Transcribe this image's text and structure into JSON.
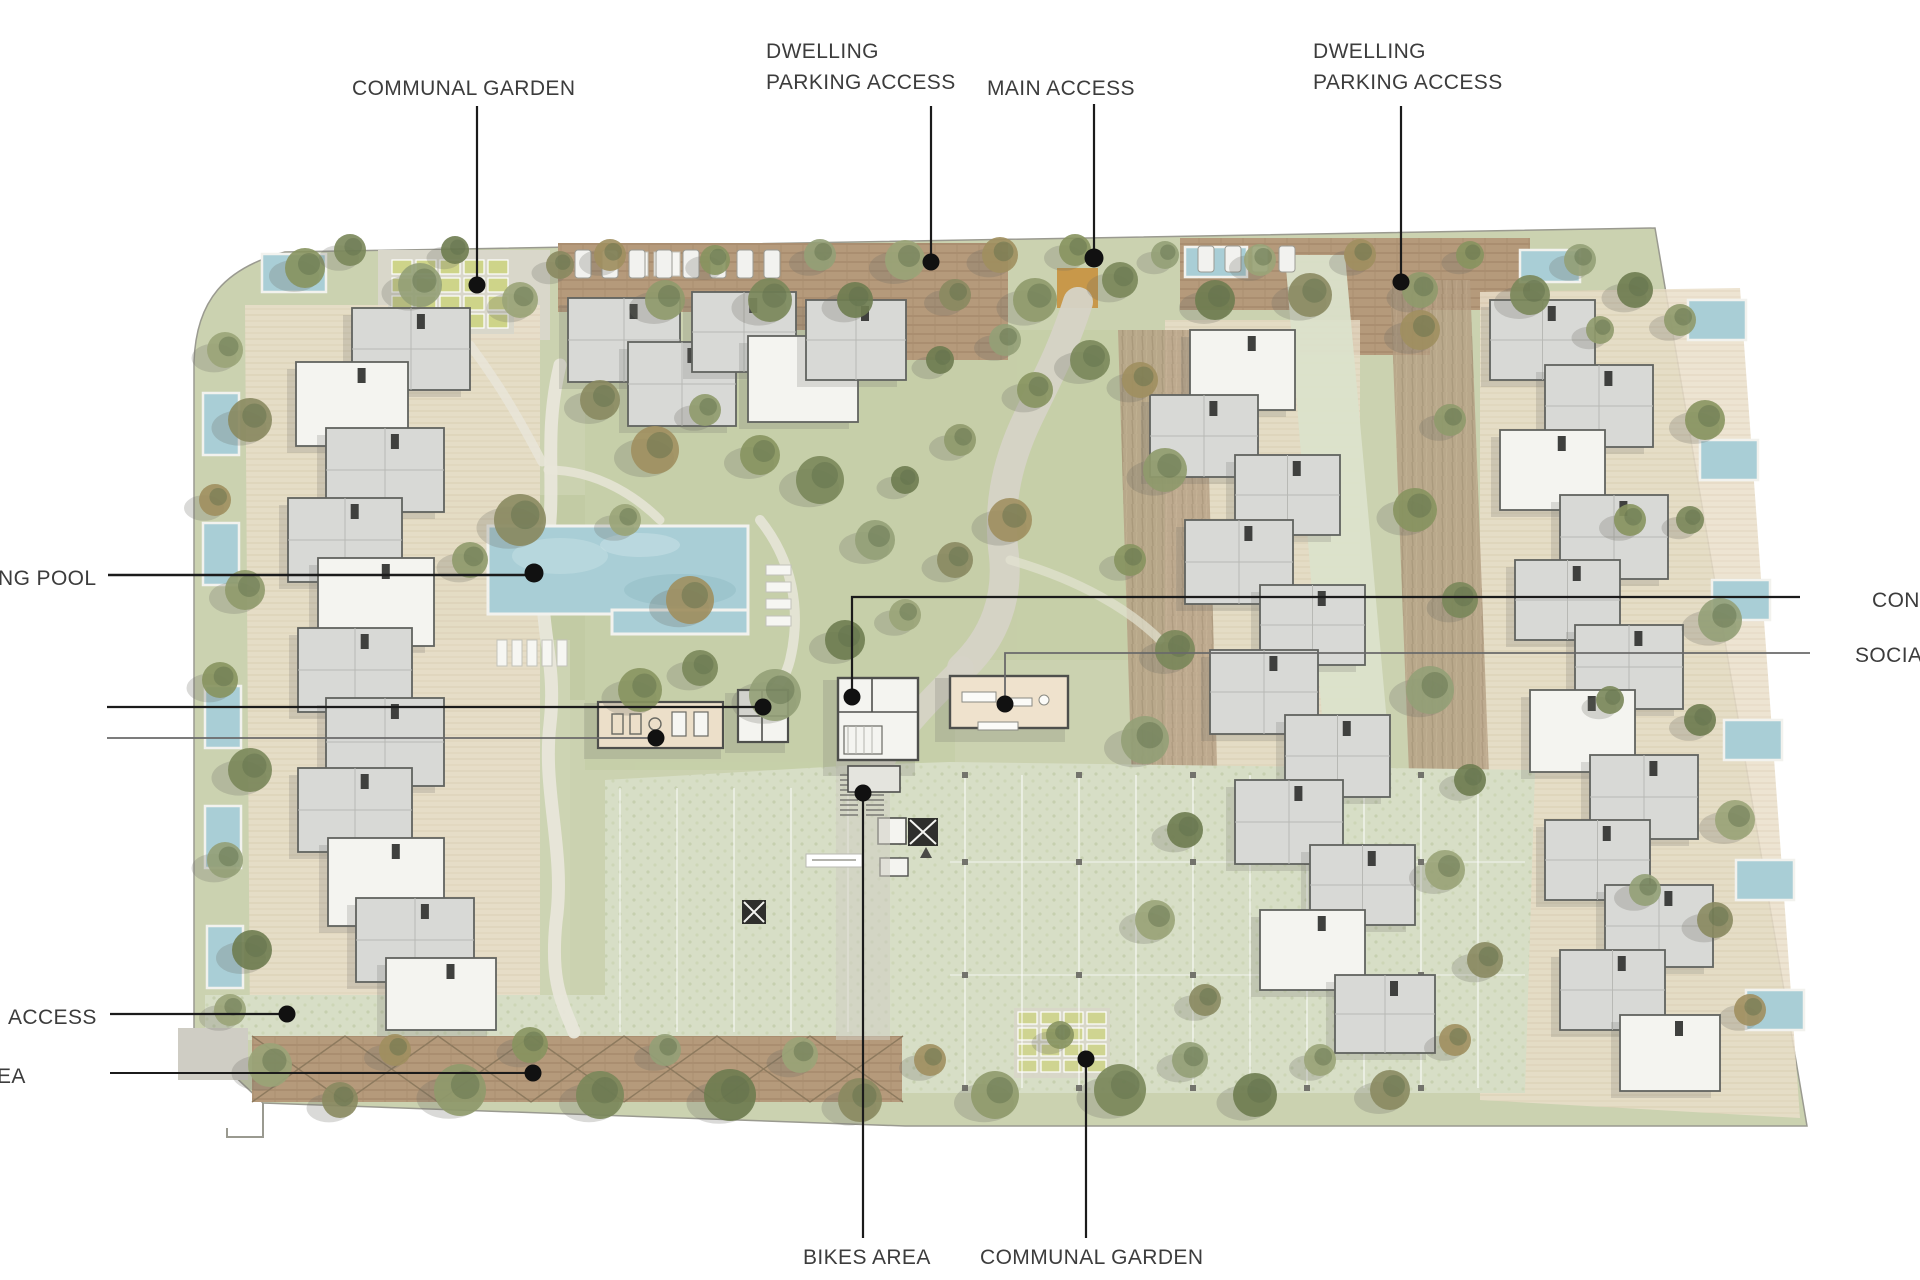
{
  "meta": {
    "title": "Residential masterplan site plan",
    "description": "Top-down rendered architectural site plan with annotation leader lines"
  },
  "labels": [
    {
      "id": "communal-garden-top",
      "text": "COMMUNAL GARDEN"
    },
    {
      "id": "dwelling-parking-access-left",
      "line1": "DWELLING",
      "line2": "PARKING ACCESS"
    },
    {
      "id": "main-access",
      "text": "MAIN ACCESS"
    },
    {
      "id": "dwelling-parking-access-right",
      "line1": "DWELLING",
      "line2": "PARKING ACCESS"
    },
    {
      "id": "swimming-pool-truncated",
      "text": "NG POOL"
    },
    {
      "id": "concierge-truncated",
      "text": "CON"
    },
    {
      "id": "social-truncated",
      "text": "SOCIA"
    },
    {
      "id": "access-truncated",
      "text": "ACCESS"
    },
    {
      "id": "area-truncated",
      "text": "EA"
    },
    {
      "id": "bikes-area",
      "text": "BIKES AREA"
    },
    {
      "id": "communal-garden-bottom",
      "text": "COMMUNAL GARDEN"
    }
  ],
  "colors": {
    "page": "#ffffff",
    "labelColor": "#3c3c3c",
    "leader": "#1b1b1b",
    "leaderSoft": "#6a6a6a",
    "lawn": "#cbd2b0",
    "lawnDark": "#bcc79c",
    "pavers": "#d7dec6",
    "deckBeige": "#eadfca",
    "timber": "#b59a7b",
    "plantedStrip": "#b49e82",
    "roofGray": "#d8d9d6",
    "buildingWhite": "#f4f4f0",
    "buildingOutline": "#61635f",
    "poolAqua": "#a9ced6",
    "treeOlive": "#87935f",
    "gateOrange": "#c8913f",
    "pathCream": "#e8e6da",
    "driveGray": "#d6d3c6"
  }
}
